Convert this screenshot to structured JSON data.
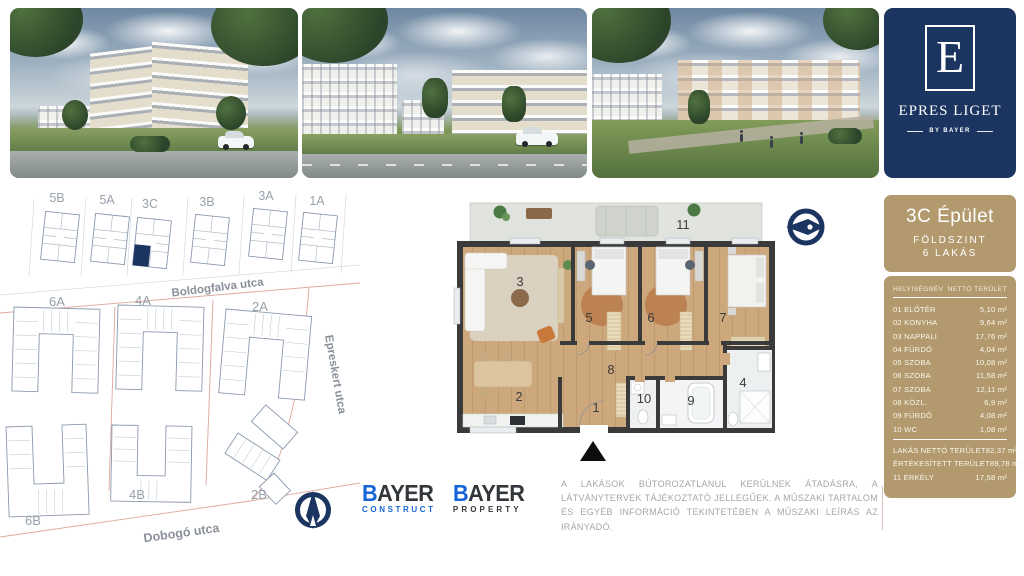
{
  "brand_card": {
    "monogram": "E",
    "title": "EPRES LIGET",
    "tagline": "BY BAYER",
    "bg": "#1c3560"
  },
  "photos": [
    {
      "name": "render-building-street"
    },
    {
      "name": "render-street-view"
    },
    {
      "name": "render-courtyard"
    }
  ],
  "sidebar": {
    "building": "3C Épület",
    "floor": "FÖLDSZINT",
    "units": "6 LAKÁS",
    "panel_color": "#b29a6e",
    "table": {
      "header": {
        "name": "HELYISÉGNÉV",
        "area": "NETTÓ TERÜLET"
      },
      "rooms": [
        {
          "label": "01 ELŐTÉR",
          "area": "5,10 m²"
        },
        {
          "label": "02 KONYHA",
          "area": "9,64 m²"
        },
        {
          "label": "03 NAPPALI",
          "area": "17,76 m²"
        },
        {
          "label": "04 FÜRDŐ",
          "area": "4,04 m²"
        },
        {
          "label": "05 SZOBA",
          "area": "10,08 m²"
        },
        {
          "label": "06 SZOBA",
          "area": "11,58 m²"
        },
        {
          "label": "07 SZOBA",
          "area": "12,11 m²"
        },
        {
          "label": "08 KÖZL.",
          "area": "6,9 m²"
        },
        {
          "label": "09 FÜRDŐ",
          "area": "4,08 m²"
        },
        {
          "label": "10 WC",
          "area": "1,08 m²"
        }
      ],
      "summary": [
        {
          "label": "LAKÁS NETTÓ TERÜLET",
          "area": "82,37 m²"
        },
        {
          "label": "ÉRTÉKESÍTETT TERÜLET",
          "area": "89,78 m²"
        },
        {
          "label": "11 ERKÉLY",
          "area": "17,58 m²"
        }
      ]
    }
  },
  "site_plan": {
    "buildings": [
      "5B",
      "5A",
      "3C",
      "3B",
      "3A",
      "1A",
      "6A",
      "4A",
      "2A",
      "6B",
      "4B",
      "2B"
    ],
    "streets": [
      "Boldogfalva utca",
      "Epreskert utca",
      "Dobogó utca"
    ],
    "highlight_color": "#1c3560",
    "parcel_line_color": "#dfa79d"
  },
  "floor_plan": {
    "room_labels": [
      "1",
      "2",
      "3",
      "4",
      "5",
      "6",
      "7",
      "8",
      "9",
      "10",
      "11"
    ]
  },
  "logos": {
    "construct": {
      "brand_b": "B",
      "brand_rest": "AYER",
      "sub": "CONSTRUCT"
    },
    "property": {
      "brand_b": "B",
      "brand_rest": "AYER",
      "sub": "PROPERTY"
    },
    "blue": "#1565d8",
    "dark": "#33373c"
  },
  "disclaimer": {
    "text": "A LAKÁSOK BÚTOROZATLANUL KERÜLNEK ÁTADÁSRA, A LÁTVÁNYTERVEK TÁJÉKOZTATÓ JELLEGŰEK. A MŰSZAKI TARTALOM ÉS EGYÉB INFORMÁCIÓ TEKINTETÉBEN A MŰSZAKI LEÍRÁS AZ IRÁNYADÓ."
  },
  "compass": {
    "color": "#1c3560"
  }
}
